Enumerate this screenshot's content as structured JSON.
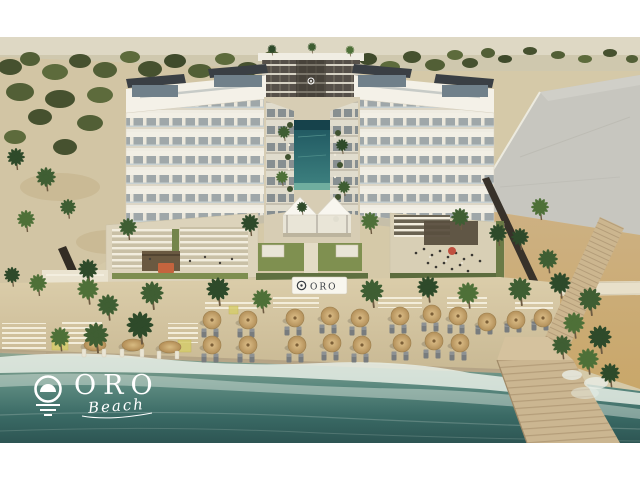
{
  "page": {
    "background": "#ffffff"
  },
  "branding": {
    "logo_text": "ORO",
    "logo_subtext": "Beach",
    "sign_text": "ORO"
  },
  "palette": {
    "logo_color": "#ffffff",
    "sign_bg": "#f8f6ee",
    "sign_text_color": "#363b41",
    "building_white": "#f3f0e7",
    "glass": "#9fa7a9",
    "rear_facade": "#565049",
    "grey_building": "#c7c6bf",
    "pool_teal": "#1d545e",
    "lawn_green": "#7f9050",
    "sand": "#d6c7a2",
    "dune_gold": "#d3ad72",
    "wet_sand": "#b2a284",
    "water_deep": "#2d5553",
    "water_mid": "#4d7f79",
    "foam": "#e8eee6",
    "pier_wood": "#cbb691",
    "umbrella_tan": "#c8a468",
    "accent_red": "#c05040",
    "mat_yellow": "#d6cd6d",
    "tree_greens": [
      "#46512f",
      "#525f36",
      "#5d6b3c",
      "#3f4a2b"
    ],
    "palm_greens": [
      "#2e4a2a",
      "#3f5e33",
      "#4e7038"
    ]
  },
  "scene": {
    "trees": [
      [
        10,
        30,
        12,
        8,
        0
      ],
      [
        30,
        22,
        10,
        7,
        1
      ],
      [
        55,
        35,
        13,
        8,
        2
      ],
      [
        80,
        24,
        11,
        7,
        0
      ],
      [
        105,
        33,
        12,
        8,
        1
      ],
      [
        130,
        20,
        10,
        6,
        2
      ],
      [
        150,
        32,
        12,
        8,
        0
      ],
      [
        175,
        24,
        11,
        7,
        3
      ],
      [
        200,
        34,
        12,
        7,
        1
      ],
      [
        225,
        22,
        10,
        6,
        2
      ],
      [
        248,
        32,
        11,
        7,
        0
      ],
      [
        272,
        20,
        9,
        6,
        1
      ],
      [
        295,
        30,
        11,
        7,
        2
      ],
      [
        320,
        22,
        10,
        6,
        0
      ],
      [
        345,
        32,
        11,
        7,
        1
      ],
      [
        368,
        22,
        9,
        6,
        3
      ],
      [
        390,
        30,
        10,
        6,
        2
      ],
      [
        412,
        20,
        9,
        6,
        0
      ],
      [
        435,
        28,
        10,
        6,
        1
      ],
      [
        455,
        18,
        8,
        5,
        2
      ],
      [
        470,
        26,
        8,
        5,
        0
      ],
      [
        488,
        16,
        7,
        5,
        1
      ],
      [
        505,
        22,
        7,
        4,
        3
      ],
      [
        530,
        14,
        7,
        4,
        0
      ],
      [
        558,
        18,
        7,
        4,
        1
      ],
      [
        585,
        22,
        7,
        4,
        2
      ],
      [
        610,
        16,
        7,
        4,
        0
      ],
      [
        632,
        22,
        6,
        4,
        1
      ],
      [
        20,
        55,
        14,
        9,
        1
      ],
      [
        60,
        62,
        15,
        9,
        0
      ],
      [
        100,
        58,
        13,
        8,
        2
      ],
      [
        140,
        64,
        14,
        8,
        3
      ],
      [
        40,
        80,
        12,
        8,
        0
      ],
      [
        90,
        86,
        13,
        8,
        1
      ],
      [
        15,
        100,
        11,
        7,
        2
      ],
      [
        65,
        110,
        12,
        8,
        0
      ]
    ],
    "palms": [
      [
        16,
        120,
        1.0,
        0
      ],
      [
        46,
        140,
        1.1,
        1
      ],
      [
        26,
        182,
        1.0,
        2
      ],
      [
        68,
        170,
        0.9,
        1
      ],
      [
        88,
        232,
        1.1,
        0
      ],
      [
        38,
        246,
        1.0,
        2
      ],
      [
        108,
        268,
        1.2,
        1
      ],
      [
        12,
        238,
        0.9,
        0
      ],
      [
        96,
        298,
        1.4,
        1
      ],
      [
        140,
        288,
        1.5,
        0
      ],
      [
        60,
        300,
        1.1,
        2
      ],
      [
        88,
        252,
        1.2,
        2
      ],
      [
        152,
        256,
        1.3,
        1
      ],
      [
        218,
        252,
        1.3,
        0
      ],
      [
        262,
        262,
        1.1,
        2
      ],
      [
        372,
        254,
        1.3,
        1
      ],
      [
        428,
        250,
        1.2,
        0
      ],
      [
        468,
        256,
        1.2,
        2
      ],
      [
        520,
        252,
        1.3,
        1
      ],
      [
        128,
        190,
        1.0,
        1
      ],
      [
        250,
        186,
        1.0,
        0
      ],
      [
        370,
        184,
        1.0,
        2
      ],
      [
        460,
        180,
        1.0,
        1
      ],
      [
        498,
        196,
        1.0,
        0
      ],
      [
        284,
        95,
        0.7,
        1
      ],
      [
        342,
        108,
        0.7,
        0
      ],
      [
        282,
        140,
        0.7,
        2
      ],
      [
        344,
        150,
        0.7,
        1
      ],
      [
        302,
        170,
        0.6,
        0
      ],
      [
        272,
        12,
        0.5,
        0
      ],
      [
        312,
        10,
        0.5,
        1
      ],
      [
        350,
        13,
        0.5,
        2
      ],
      [
        540,
        170,
        1.0,
        2
      ],
      [
        520,
        200,
        1.0,
        0
      ],
      [
        548,
        222,
        1.1,
        1
      ],
      [
        560,
        246,
        1.2,
        0
      ],
      [
        590,
        262,
        1.3,
        1
      ],
      [
        574,
        286,
        1.2,
        2
      ],
      [
        600,
        300,
        1.3,
        0
      ],
      [
        562,
        308,
        1.1,
        1
      ],
      [
        588,
        322,
        1.2,
        2
      ],
      [
        610,
        336,
        1.1,
        0
      ]
    ],
    "umbrellas": [
      [
        212,
        283
      ],
      [
        248,
        283
      ],
      [
        212,
        308
      ],
      [
        248,
        308
      ],
      [
        295,
        281
      ],
      [
        330,
        279
      ],
      [
        360,
        281
      ],
      [
        297,
        308
      ],
      [
        332,
        306
      ],
      [
        362,
        308
      ],
      [
        400,
        279
      ],
      [
        432,
        277
      ],
      [
        458,
        279
      ],
      [
        402,
        306
      ],
      [
        434,
        304
      ],
      [
        460,
        306
      ],
      [
        487,
        285
      ],
      [
        516,
        283
      ],
      [
        543,
        281
      ]
    ],
    "round_beds": [
      [
        95,
        308
      ],
      [
        133,
        308
      ],
      [
        170,
        310
      ]
    ],
    "loungers_grey": [
      [
        204,
        296
      ],
      [
        216,
        296
      ],
      [
        240,
        296
      ],
      [
        252,
        296
      ],
      [
        204,
        321
      ],
      [
        216,
        321
      ],
      [
        240,
        321
      ],
      [
        252,
        321
      ],
      [
        287,
        294
      ],
      [
        299,
        294
      ],
      [
        322,
        292
      ],
      [
        334,
        292
      ],
      [
        352,
        294
      ],
      [
        364,
        294
      ],
      [
        289,
        321
      ],
      [
        301,
        321
      ],
      [
        324,
        319
      ],
      [
        336,
        319
      ],
      [
        354,
        321
      ],
      [
        366,
        321
      ],
      [
        392,
        292
      ],
      [
        404,
        292
      ],
      [
        424,
        290
      ],
      [
        436,
        290
      ],
      [
        450,
        292
      ],
      [
        462,
        292
      ],
      [
        394,
        319
      ],
      [
        406,
        319
      ],
      [
        426,
        317
      ],
      [
        438,
        317
      ],
      [
        452,
        319
      ],
      [
        464,
        319
      ],
      [
        478,
        293
      ],
      [
        490,
        293
      ],
      [
        507,
        291
      ],
      [
        519,
        291
      ],
      [
        534,
        289
      ],
      [
        546,
        289
      ]
    ],
    "loungers_white": [
      [
        84,
        316
      ],
      [
        104,
        316
      ],
      [
        122,
        316
      ],
      [
        142,
        316
      ],
      [
        159,
        318
      ],
      [
        177,
        318
      ]
    ],
    "yellow_mats": [
      [
        52,
        301,
        16,
        12
      ],
      [
        178,
        303,
        13,
        12
      ],
      [
        229,
        269,
        9,
        8
      ]
    ],
    "walk_mats": [
      [
        205,
        262,
        52,
        13
      ],
      [
        273,
        260,
        46,
        11
      ],
      [
        378,
        260,
        44,
        11
      ],
      [
        447,
        260,
        40,
        11
      ],
      [
        515,
        262,
        38,
        12
      ],
      [
        62,
        284,
        40,
        26
      ],
      [
        168,
        286,
        30,
        20
      ],
      [
        2,
        286,
        44,
        36
      ]
    ]
  }
}
